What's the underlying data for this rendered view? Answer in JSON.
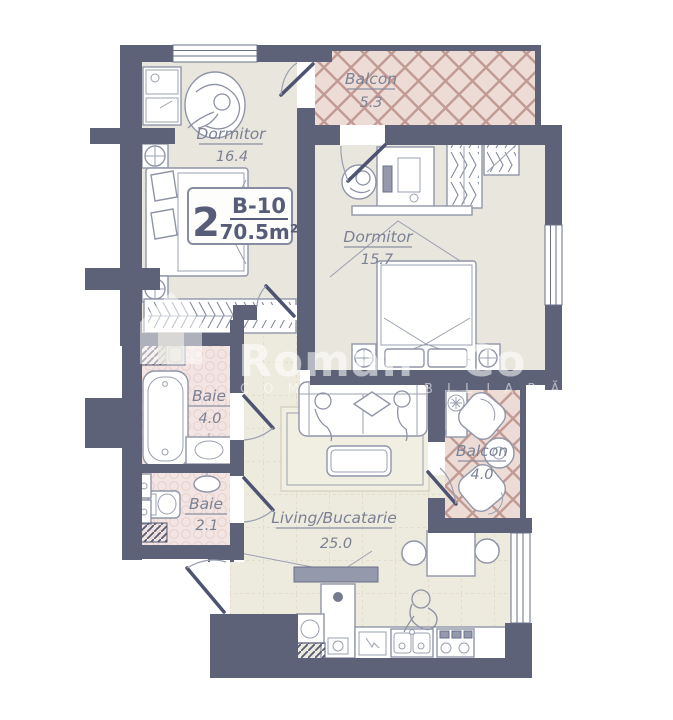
{
  "unit_badge": {
    "rooms": "2",
    "code": "B-10",
    "area": "70.5m²"
  },
  "rooms": {
    "dormitor1": {
      "name": "Dormitor",
      "area": "16.4"
    },
    "balcon1": {
      "name": "Balcon",
      "area": "5.3"
    },
    "dormitor2": {
      "name": "Dormitor",
      "area": "15.7"
    },
    "baie1": {
      "name": "Baie",
      "area": "4.0"
    },
    "baie2": {
      "name": "Baie",
      "area": "2.1"
    },
    "living": {
      "name": "Living/Bucatarie",
      "area": "25.0"
    },
    "balcon2": {
      "name": "Balcon",
      "area": "4.0"
    }
  },
  "watermark": {
    "brand_left": "Roman",
    "brand_right": "Co",
    "tagline_left": "C O M",
    "tagline_right": "B I L I A R Ă"
  },
  "colors": {
    "wall": "#5d6278",
    "bedroom_floor": "#e8e6dd",
    "living_floor": "#edeade",
    "balcony_floor": "#eddcd6",
    "bath_floor": "#f3e5e3",
    "lattice_line": "#c19b93",
    "label_text": "#7b8194",
    "badge_text": "#575d78"
  }
}
